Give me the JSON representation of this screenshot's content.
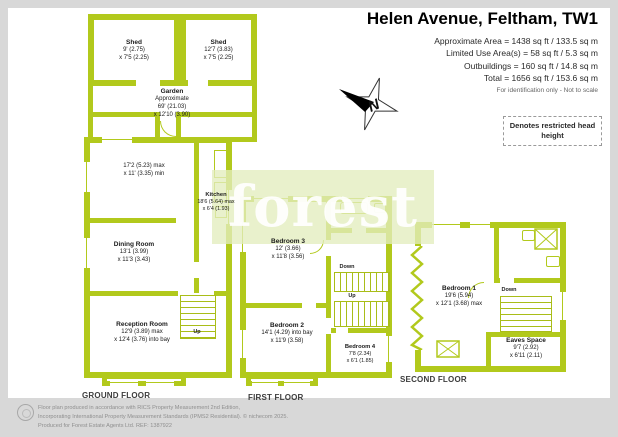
{
  "header": {
    "title": "Helen Avenue, Feltham, TW1",
    "area_lines": [
      "Approximate Area = 1438 sq ft / 133.5 sq m",
      "Limited Use Area(s) = 58 sq ft / 5.3 sq m",
      "Outbuildings = 160 sq ft / 14.8 sq m",
      "Total = 1656 sq ft / 153.6 sq m"
    ],
    "note": "For identification only - Not to scale"
  },
  "legend": {
    "restricted_head_height": "Denotes restricted head height"
  },
  "compass": {
    "north": "N"
  },
  "watermark": {
    "text": "forest"
  },
  "floors": {
    "ground": {
      "label": "GROUND FLOOR"
    },
    "first": {
      "label": "FIRST FLOOR"
    },
    "second": {
      "label": "SECOND FLOOR"
    }
  },
  "rooms": {
    "shed_left": {
      "name": "Shed",
      "dims": [
        "9' (2.75)",
        "x 7'5 (2.25)"
      ]
    },
    "shed_right": {
      "name": "Shed",
      "dims": [
        "12'7 (3.83)",
        "x 7'5 (2.25)"
      ]
    },
    "garden": {
      "name": "Garden",
      "dims": [
        "Approximate",
        "69' (21.03)",
        "x 12'10 (3.90)"
      ]
    },
    "sitting_area": {
      "dims": [
        "17'2 (5.23) max",
        "x 11' (3.35) min"
      ]
    },
    "kitchen": {
      "name": "Kitchen",
      "dims": [
        "18'6 (5.64) max",
        "x 6'4 (1.93)"
      ]
    },
    "dining_room": {
      "name": "Dining Room",
      "dims": [
        "13'1 (3.99)",
        "x 11'3 (3.43)"
      ]
    },
    "reception_room": {
      "name": "Reception Room",
      "dims": [
        "12'9 (3.89) max",
        "x 12'4 (3.76) into bay"
      ]
    },
    "bedroom3": {
      "name": "Bedroom 3",
      "dims": [
        "12' (3.66)",
        "x 11'8 (3.56)"
      ]
    },
    "bedroom2": {
      "name": "Bedroom 2",
      "dims": [
        "14'1 (4.29) into bay",
        "x 11'9 (3.58)"
      ]
    },
    "bedroom4": {
      "name": "Bedroom 4",
      "dims": [
        "7'8 (2.34)",
        "x 6'1 (1.85)"
      ]
    },
    "bedroom1": {
      "name": "Bedroom 1",
      "dims": [
        "19'6 (5.94)",
        "x 12'1 (3.68) max"
      ]
    },
    "eaves_space": {
      "name": "Eaves Space",
      "dims": [
        "9'7 (2.92)",
        "x 6'11 (2.11)"
      ]
    }
  },
  "stairs": {
    "up": "Up",
    "down": "Down"
  },
  "footer": {
    "line1": "Floor plan produced in accordance with RICS Property Measurement 2nd Edition,",
    "line2": "Incorporating International Property Measurement Standards (IPMS2 Residential).  © nichecom 2025.",
    "line3": "Produced for Forest Estate Agents Ltd.   REF: 1387922"
  },
  "colors": {
    "wall": "#b2c91c",
    "frame_bg": "#d8d8d8",
    "watermark_band": "#e3edbe"
  }
}
